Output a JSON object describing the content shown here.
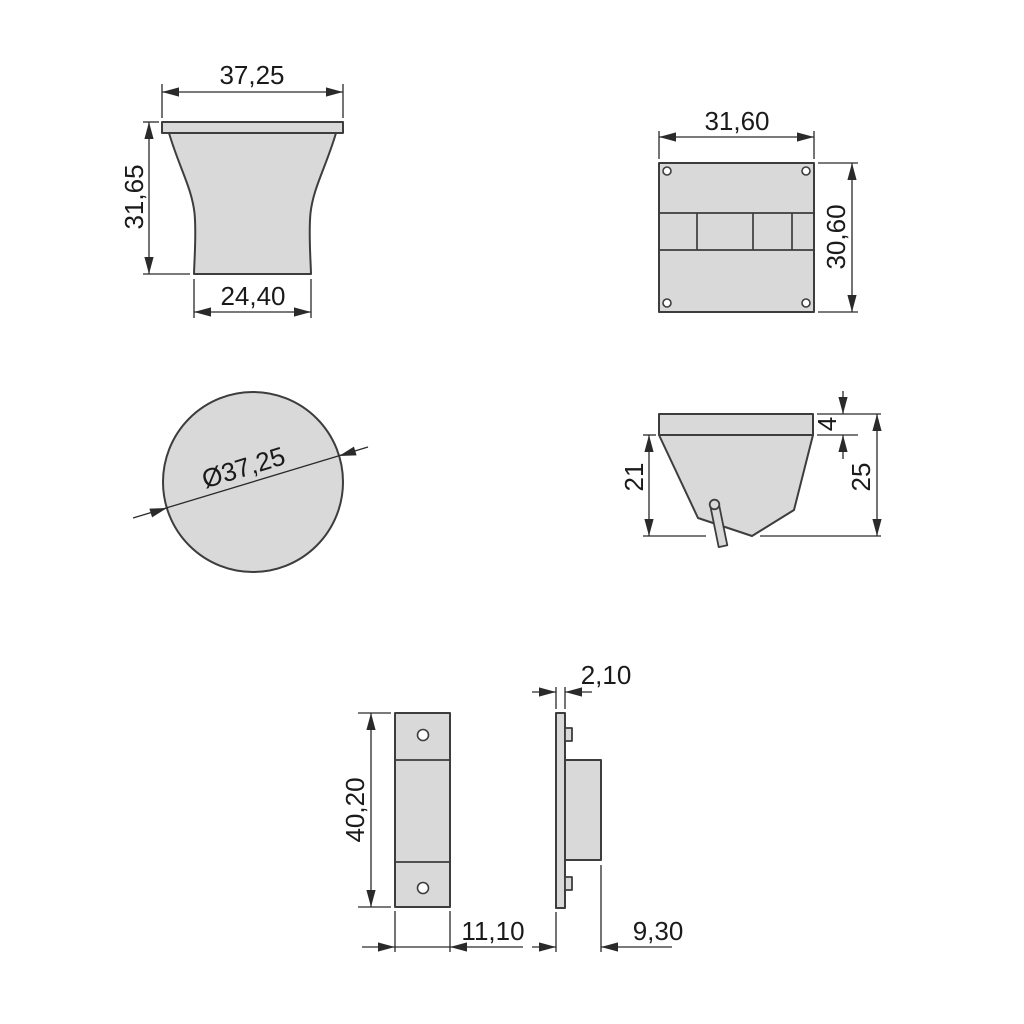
{
  "colors": {
    "part-fill": "#d9d9d9",
    "outline": "#3d3d3d",
    "dim": "#2a2a2a",
    "text": "#1a1a1a",
    "bg": "#ffffff"
  },
  "views": {
    "knob_front": {
      "top_width": "37,25",
      "height": "31,65",
      "bottom_width": "24,40"
    },
    "back_plate": {
      "width": "31,60",
      "height": "30,60"
    },
    "knob_top": {
      "diameter": "Ø37,25"
    },
    "hook_side": {
      "flange_thickness": "4",
      "body_depth": "21",
      "total_depth": "25"
    },
    "bracket_front": {
      "height": "40,20",
      "width": "11,10"
    },
    "bracket_side": {
      "thickness": "2,10",
      "depth": "9,30"
    }
  }
}
